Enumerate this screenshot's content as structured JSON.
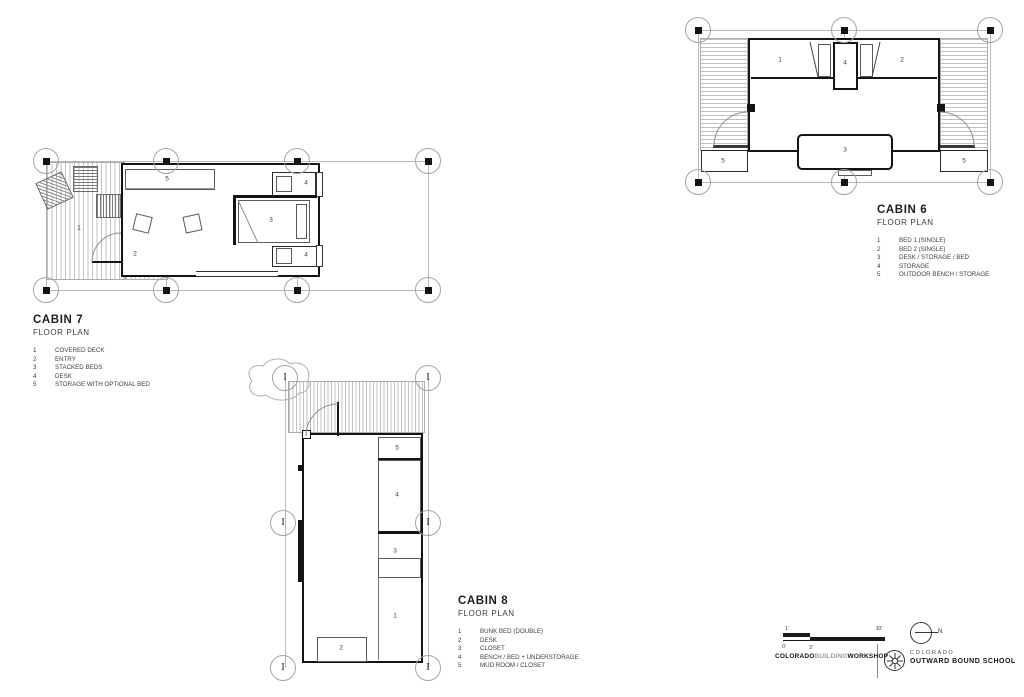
{
  "cabins": {
    "cabin7": {
      "title": "CABIN 7",
      "subtitle": "FLOOR PLAN",
      "legend": [
        {
          "num": "1",
          "label": "COVERED DECK"
        },
        {
          "num": "2",
          "label": "ENTRY"
        },
        {
          "num": "3",
          "label": "STACKED BEDS"
        },
        {
          "num": "4",
          "label": "DESK"
        },
        {
          "num": "5",
          "label": "STORAGE WITH OPTIONAL BED"
        }
      ],
      "room_labels": {
        "deck": "1",
        "entry": "2",
        "beds": "3",
        "desk_top": "4",
        "desk_bottom": "4",
        "storage": "5"
      }
    },
    "cabin6": {
      "title": "CABIN 6",
      "subtitle": "FLOOR PLAN",
      "legend": [
        {
          "num": "1",
          "label": "BED 1 (SINGLE)"
        },
        {
          "num": "2",
          "label": "BED 2 (SINGLE)"
        },
        {
          "num": "3",
          "label": "DESK / STORAGE / BED"
        },
        {
          "num": "4",
          "label": "STORAGE"
        },
        {
          "num": "5",
          "label": "OUTDOOR BENCH / STORAGE"
        }
      ],
      "room_labels": {
        "bed1": "1",
        "bed2": "2",
        "desk": "3",
        "storage": "4",
        "bench_left": "5",
        "bench_right": "5"
      }
    },
    "cabin8": {
      "title": "CABIN 8",
      "subtitle": "FLOOR PLAN",
      "legend": [
        {
          "num": "1",
          "label": "BUNK BED (DOUBLE)"
        },
        {
          "num": "2",
          "label": "DESK"
        },
        {
          "num": "3",
          "label": "CLOSET"
        },
        {
          "num": "4",
          "label": "BENCH / BED + UNDERSTORAGE"
        },
        {
          "num": "5",
          "label": "MUD ROOM / CLOSET"
        }
      ],
      "room_labels": {
        "bunk": "1",
        "desk": "2",
        "closet": "3",
        "bench": "4",
        "mudroom": "5"
      },
      "column_symbol": "I"
    }
  },
  "titleblock": {
    "scale_labels": {
      "one": "1'",
      "ten": "10'",
      "zero": "0'",
      "three": "3'"
    },
    "north_label": "N",
    "firm": {
      "part1": "COLORADO",
      "part2": "BUILDING",
      "part3": "WORKSHOP"
    },
    "client": {
      "line1": "COLORADO",
      "line2": "OUTWARD BOUND SCHOOL"
    }
  }
}
